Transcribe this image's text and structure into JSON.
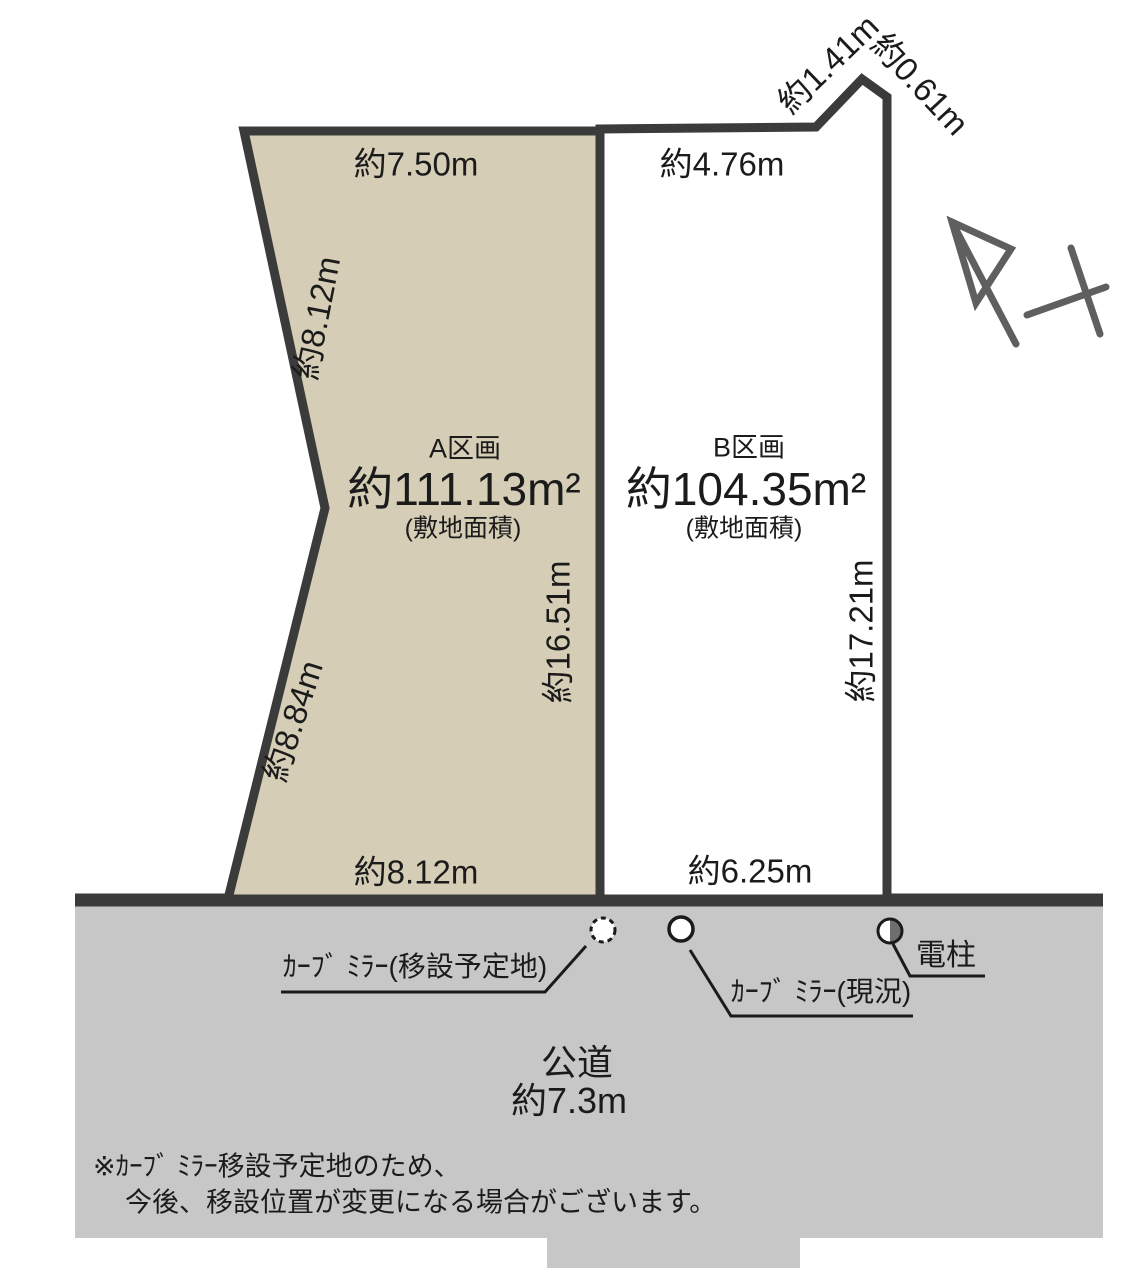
{
  "parcels": {
    "a": {
      "name": "A区画",
      "area": "約111.13m²",
      "area_caption": "(敷地面積)"
    },
    "b": {
      "name": "B区画",
      "area": "約104.35m²",
      "area_caption": "(敷地面積)"
    }
  },
  "dims": {
    "a_top": "約7.50m",
    "b_top": "約4.76m",
    "ne_diag_left": "約1.41m",
    "ne_diag_right": "約0.61m",
    "a_left_upper": "約8.12m",
    "a_left_lower": "約8.84m",
    "a_right": "約16.51m",
    "b_right": "約17.21m",
    "a_bottom": "約8.12m",
    "b_bottom": "約6.25m"
  },
  "road": {
    "name": "公道",
    "width": "約7.3m"
  },
  "markers": {
    "mirror_planned": "ｶｰﾌﾞ ﾐﾗｰ(移設予定地)",
    "mirror_current": "ｶｰﾌﾞ ﾐﾗｰ(現況)",
    "utility_pole": "電柱"
  },
  "note": {
    "line1": "※ｶｰﾌﾞ ﾐﾗｰ移設予定地のため、",
    "line2": "今後、移設位置が変更になる場合がございます。"
  },
  "colors": {
    "parcel_a_fill": "#d5cdb6",
    "parcel_b_fill": "#ffffff",
    "road_fill": "#c7c7c7",
    "boundary": "#3b3b3b",
    "leader": "#1a1a1a",
    "north_arrow": "#5f5f5f",
    "pole_half": "#6e6e6e"
  }
}
